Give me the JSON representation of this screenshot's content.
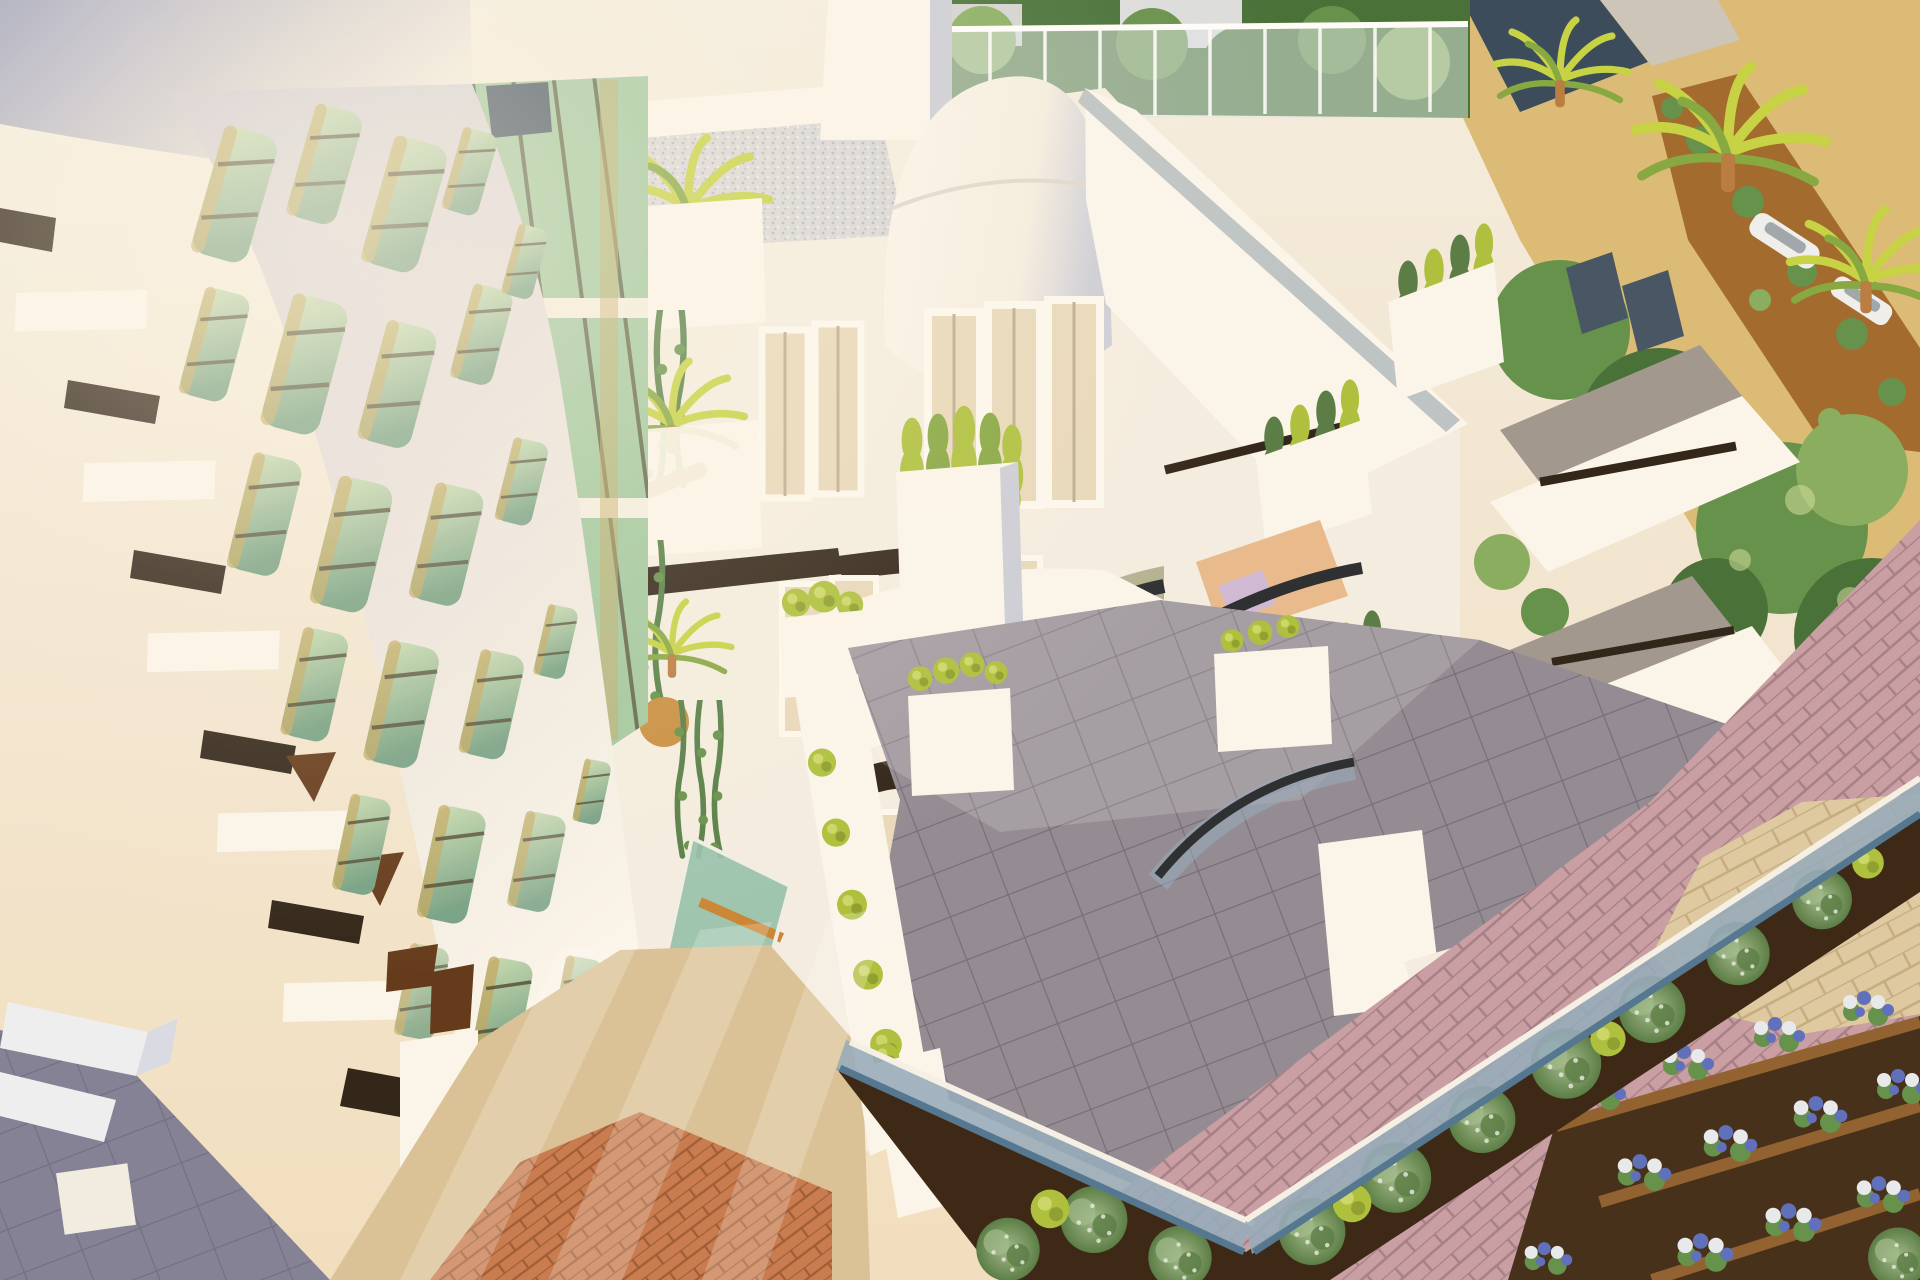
{
  "scene": {
    "type": "3d-architectural-render",
    "subject": "Aerial view 3D rendering of a modern white apartment building with a curved organic perforated facade screen over green glass, stepped balconies with planters and hedges, a gravel roof terrace, palm trees, a tiled courtyard with glass balustrades, round bushes in dark soil beds, pink and orange brick paving, sandy garden paths, trees and parked cars in the background",
    "alt": "Sunlit white residential building seen from above with voronoi-patterned facade, balconies full of plants, gray tiled terraces, glass railings, landscaped garden with bushes, flower beds and brick paving"
  },
  "palette": {
    "tower_left": "#9aa0bf",
    "tower_right": "#efe9df",
    "wall_white": "#f4eee3",
    "wall_bright": "#fbf7ee",
    "wall_cream": "#f1dfc1",
    "wall_warm": "#eccfa8",
    "wall_shade": "#c9cdda",
    "wall_shade_dark": "#a3a8bf",
    "lattice_light": "#e9e4e0",
    "lattice_shade": "#c7c6d4",
    "glass_green_light": "#c6ddb4",
    "glass_green": "#9cc79e",
    "glass_teal": "#8fc0ac",
    "glass_green_dark": "#6f9e82",
    "glass_pale": "#dde8c9",
    "glass_gold": "#bfa55e",
    "frame_dark": "#45402d",
    "slit_dark": "#241a10",
    "opening_brown": "#5a3012",
    "gravel": "#d7d8da",
    "gravel_dot": "#b4b7bf",
    "tree_dark": "#3c6a31",
    "tree_mid": "#5c8d45",
    "tree_light": "#82ab5c",
    "bush_green": "#50773f",
    "bush_speck": "#9db98a",
    "bush_lime": "#a9bf37",
    "sand": "#d9ba74",
    "dirt_path": "#9c6425",
    "soil_dark": "#2f1d0c",
    "brick_pink": "#c69ba4",
    "brick_pink_joint": "#a07a85",
    "brick_orange": "#c5764a",
    "brick_orange_joint": "#99552e",
    "stone_path": "#dcc9a1",
    "stone_joint": "#c0a97e",
    "path_beige": "#d9c096",
    "tile_gray": "#8d8793",
    "tile_joint": "#6e6876",
    "tile_sun": "#b7aeb4",
    "glass_rail": "#8fa9bd",
    "glass_rail_deep": "#49708f",
    "rail_dark": "#20242a",
    "palm_lime": "#c3d23e",
    "palm_green": "#7fa53c",
    "palm_trunk": "#b5773c",
    "vine_green": "#4c7a42",
    "flower_white": "#e7ebf2",
    "flower_blue": "#5569bd",
    "planter_wood": "#8a5a28",
    "roof_navy": "#2e4257",
    "window_slate": "#3c4d60",
    "deck_gray": "#9b948c",
    "floor_peach": "#e8b98a",
    "chair_lilac": "#cdb8d8",
    "door_glass": "#e8d9bc"
  }
}
